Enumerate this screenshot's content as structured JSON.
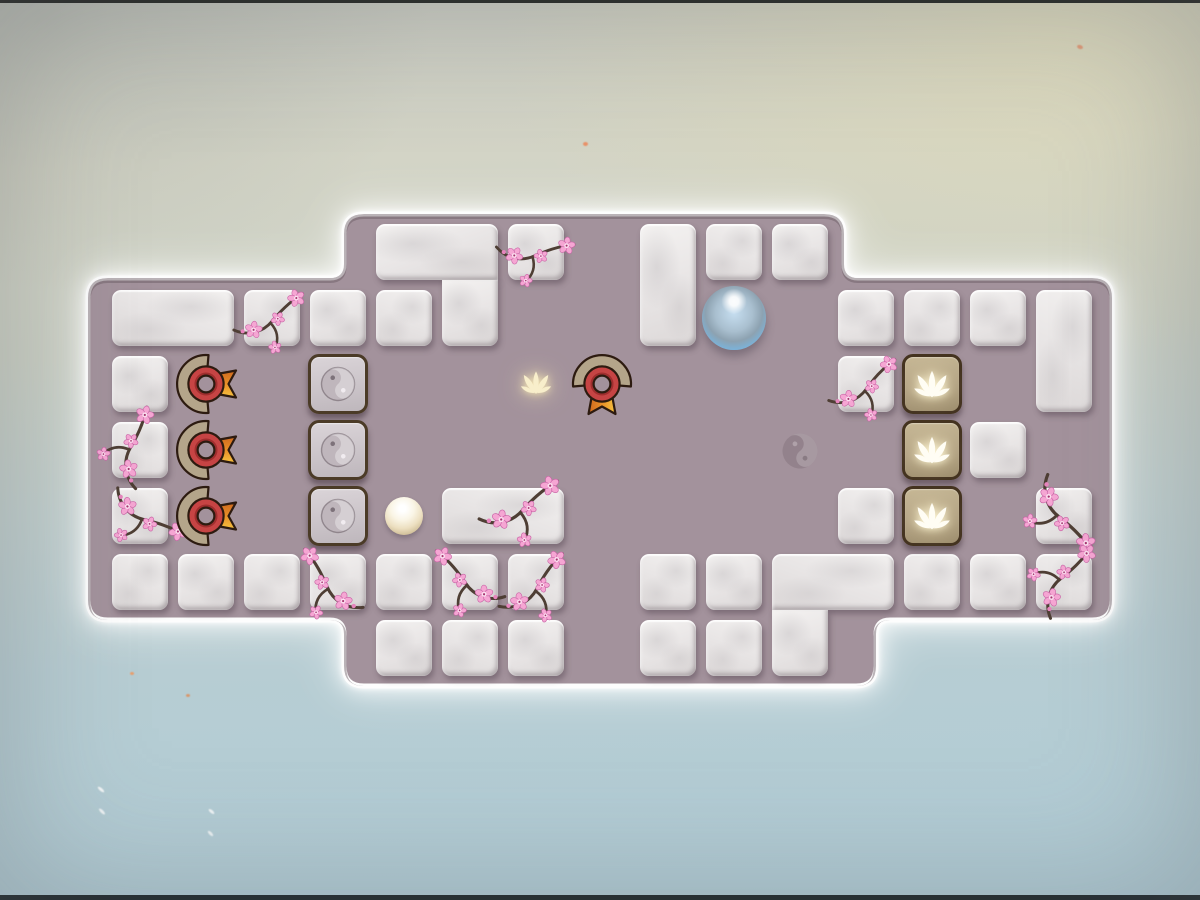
{
  "palette": {
    "board_fill": "#a3929c",
    "board_rim": "#fdfdfd",
    "marble_tile": "#e9e6e6",
    "zen_tile_face": "#cdc6cb",
    "lotus_tile_face": "#b2a283",
    "tan_border": "#44331f",
    "medal_red": "#c64444",
    "medal_arc": "#b4a58a",
    "ribbon_dark_orange": "#cf6a1e",
    "ribbon_gold": "#f6c13f",
    "outline_dark": "#2d1b10",
    "ball_blue": "#5ba3d4",
    "pearl": "#f3ecd8",
    "blossom_pink": "#f5a6d3",
    "blossom_deep_pink": "#c964a6",
    "blossom_center": "#a4356f",
    "branch_brown": "#4e3e34",
    "glow_lotus": "#f8eecb",
    "lotus_white": "#fffdf4"
  },
  "board": {
    "path": "M108,278 H330 Q344,278 344,264 V234 Q344,214 364,214 H824 Q844,214 844,234 V264 Q844,278 858,278 H1092 Q1112,278 1112,298 V600 Q1112,620 1092,620 H890 Q876,620 876,634 V666 Q876,686 856,686 H364 Q344,686 344,666 V634 Q344,620 330,620 H108 Q88,620 88,600 V298 Q88,278 108,278 Z"
  },
  "grid": {
    "origin_x": 112,
    "origin_y": 224,
    "pitch": 66,
    "tile": 56,
    "cols": 15,
    "rows": 7
  },
  "tiles": {
    "marble": [
      {
        "c": 4,
        "r": 0,
        "w": 2,
        "cut": [
          "br"
        ]
      },
      {
        "c": 5,
        "r": 1,
        "cut": [
          "tl",
          "tr"
        ],
        "ext": "up"
      },
      {
        "c": 6,
        "r": 0
      },
      {
        "c": 8,
        "r": 0,
        "h": 2
      },
      {
        "c": 9,
        "r": 0
      },
      {
        "c": 10,
        "r": 0
      },
      {
        "c": 0,
        "r": 1,
        "w": 2
      },
      {
        "c": 2,
        "r": 1
      },
      {
        "c": 3,
        "r": 1
      },
      {
        "c": 4,
        "r": 1
      },
      {
        "c": 11,
        "r": 1
      },
      {
        "c": 12,
        "r": 1
      },
      {
        "c": 13,
        "r": 1
      },
      {
        "c": 14,
        "r": 1,
        "h": 2
      },
      {
        "c": 0,
        "r": 2
      },
      {
        "c": 11,
        "r": 2
      },
      {
        "c": 0,
        "r": 3
      },
      {
        "c": 13,
        "r": 3
      },
      {
        "c": 0,
        "r": 4
      },
      {
        "c": 5,
        "r": 4,
        "w": 2
      },
      {
        "c": 11,
        "r": 4
      },
      {
        "c": 14,
        "r": 4
      },
      {
        "c": 0,
        "r": 5
      },
      {
        "c": 1,
        "r": 5
      },
      {
        "c": 2,
        "r": 5
      },
      {
        "c": 3,
        "r": 5
      },
      {
        "c": 4,
        "r": 5
      },
      {
        "c": 5,
        "r": 5
      },
      {
        "c": 6,
        "r": 5
      },
      {
        "c": 8,
        "r": 5
      },
      {
        "c": 9,
        "r": 5
      },
      {
        "c": 10,
        "r": 5,
        "w": 2,
        "cut": [
          "bl"
        ]
      },
      {
        "c": 10,
        "r": 6,
        "cut": [
          "tl",
          "tr"
        ],
        "ext": "up"
      },
      {
        "c": 12,
        "r": 5
      },
      {
        "c": 13,
        "r": 5
      },
      {
        "c": 14,
        "r": 5
      },
      {
        "c": 4,
        "r": 6
      },
      {
        "c": 5,
        "r": 6
      },
      {
        "c": 6,
        "r": 6
      },
      {
        "c": 8,
        "r": 6
      },
      {
        "c": 9,
        "r": 6
      }
    ],
    "zen": [
      {
        "c": 3,
        "r": 2
      },
      {
        "c": 3,
        "r": 3
      },
      {
        "c": 3,
        "r": 4
      }
    ],
    "lotus": [
      {
        "c": 12,
        "r": 2
      },
      {
        "c": 12,
        "r": 3
      },
      {
        "c": 12,
        "r": 4
      }
    ]
  },
  "pieces": {
    "medals": [
      {
        "c": 1,
        "r": 2,
        "dir": "right"
      },
      {
        "c": 1,
        "r": 3,
        "dir": "right"
      },
      {
        "c": 1,
        "r": 4,
        "dir": "right"
      },
      {
        "c": 7,
        "r": 2,
        "dir": "down"
      }
    ],
    "balls": [
      {
        "kind": "blue",
        "c": 9,
        "r": 1,
        "d": 64
      },
      {
        "kind": "pearl",
        "c": 4,
        "r": 4,
        "d": 38
      }
    ]
  },
  "decals": {
    "glow_lotus": {
      "c": 6,
      "r": 2
    },
    "yinyang_floor": {
      "c": 10,
      "r": 3
    }
  },
  "blossoms": [
    {
      "x": 270,
      "y": 316,
      "rot": -8,
      "s": 0.85,
      "flip": false
    },
    {
      "x": 534,
      "y": 250,
      "rot": 18,
      "s": 0.85,
      "flip": false
    },
    {
      "x": 134,
      "y": 446,
      "rot": 78,
      "s": 0.9,
      "flip": true
    },
    {
      "x": 146,
      "y": 514,
      "rot": 55,
      "s": 0.9,
      "flip": false
    },
    {
      "x": 864,
      "y": 384,
      "rot": -12,
      "s": 0.85,
      "flip": false
    },
    {
      "x": 1062,
      "y": 512,
      "rot": 80,
      "s": 0.95,
      "flip": false
    },
    {
      "x": 1064,
      "y": 578,
      "rot": 100,
      "s": 0.9,
      "flip": true
    },
    {
      "x": 520,
      "y": 505,
      "rot": -6,
      "s": 0.95,
      "flip": false
    },
    {
      "x": 468,
      "y": 578,
      "rot": 14,
      "s": 0.9,
      "flip": true
    },
    {
      "x": 534,
      "y": 584,
      "rot": -20,
      "s": 0.9,
      "flip": false
    },
    {
      "x": 330,
      "y": 582,
      "rot": 25,
      "s": 0.9,
      "flip": true
    }
  ],
  "speckles": [
    {
      "x": 583,
      "y": 142,
      "w": 5,
      "h": 4,
      "rot": 0,
      "color": "#e8936a"
    },
    {
      "x": 1077,
      "y": 45,
      "w": 6,
      "h": 4,
      "rot": 20,
      "color": "#e09a78"
    },
    {
      "x": 130,
      "y": 672,
      "w": 4,
      "h": 3,
      "rot": 0,
      "color": "#e8a070"
    },
    {
      "x": 186,
      "y": 694,
      "w": 4,
      "h": 3,
      "rot": 0,
      "color": "#d7986e"
    },
    {
      "x": 97,
      "y": 788,
      "w": 8,
      "h": 3,
      "rot": 40,
      "color": "rgba(255,255,255,.85)"
    },
    {
      "x": 98,
      "y": 810,
      "w": 8,
      "h": 3,
      "rot": 45,
      "color": "rgba(255,255,255,.8)"
    },
    {
      "x": 208,
      "y": 810,
      "w": 7,
      "h": 3,
      "rot": 40,
      "color": "rgba(255,255,255,.8)"
    },
    {
      "x": 207,
      "y": 832,
      "w": 7,
      "h": 3,
      "rot": 45,
      "color": "rgba(255,255,255,.75)"
    }
  ]
}
